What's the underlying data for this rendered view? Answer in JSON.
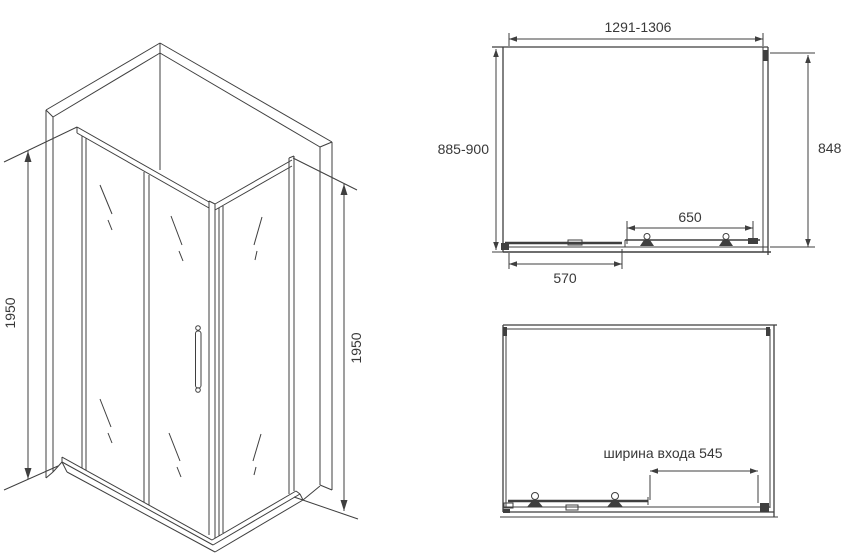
{
  "colors": {
    "line": "#3f3f3f",
    "text": "#383838",
    "background": "#ffffff"
  },
  "iso_view": {
    "left_height": "1950",
    "right_height": "1950"
  },
  "top_view": {
    "width_range": "1291-1306",
    "depth_range": "885-900",
    "side_height": "848",
    "inner_span": "650",
    "outer_span": "570"
  },
  "bottom_view": {
    "entrance_width": "ширина входа 545"
  }
}
